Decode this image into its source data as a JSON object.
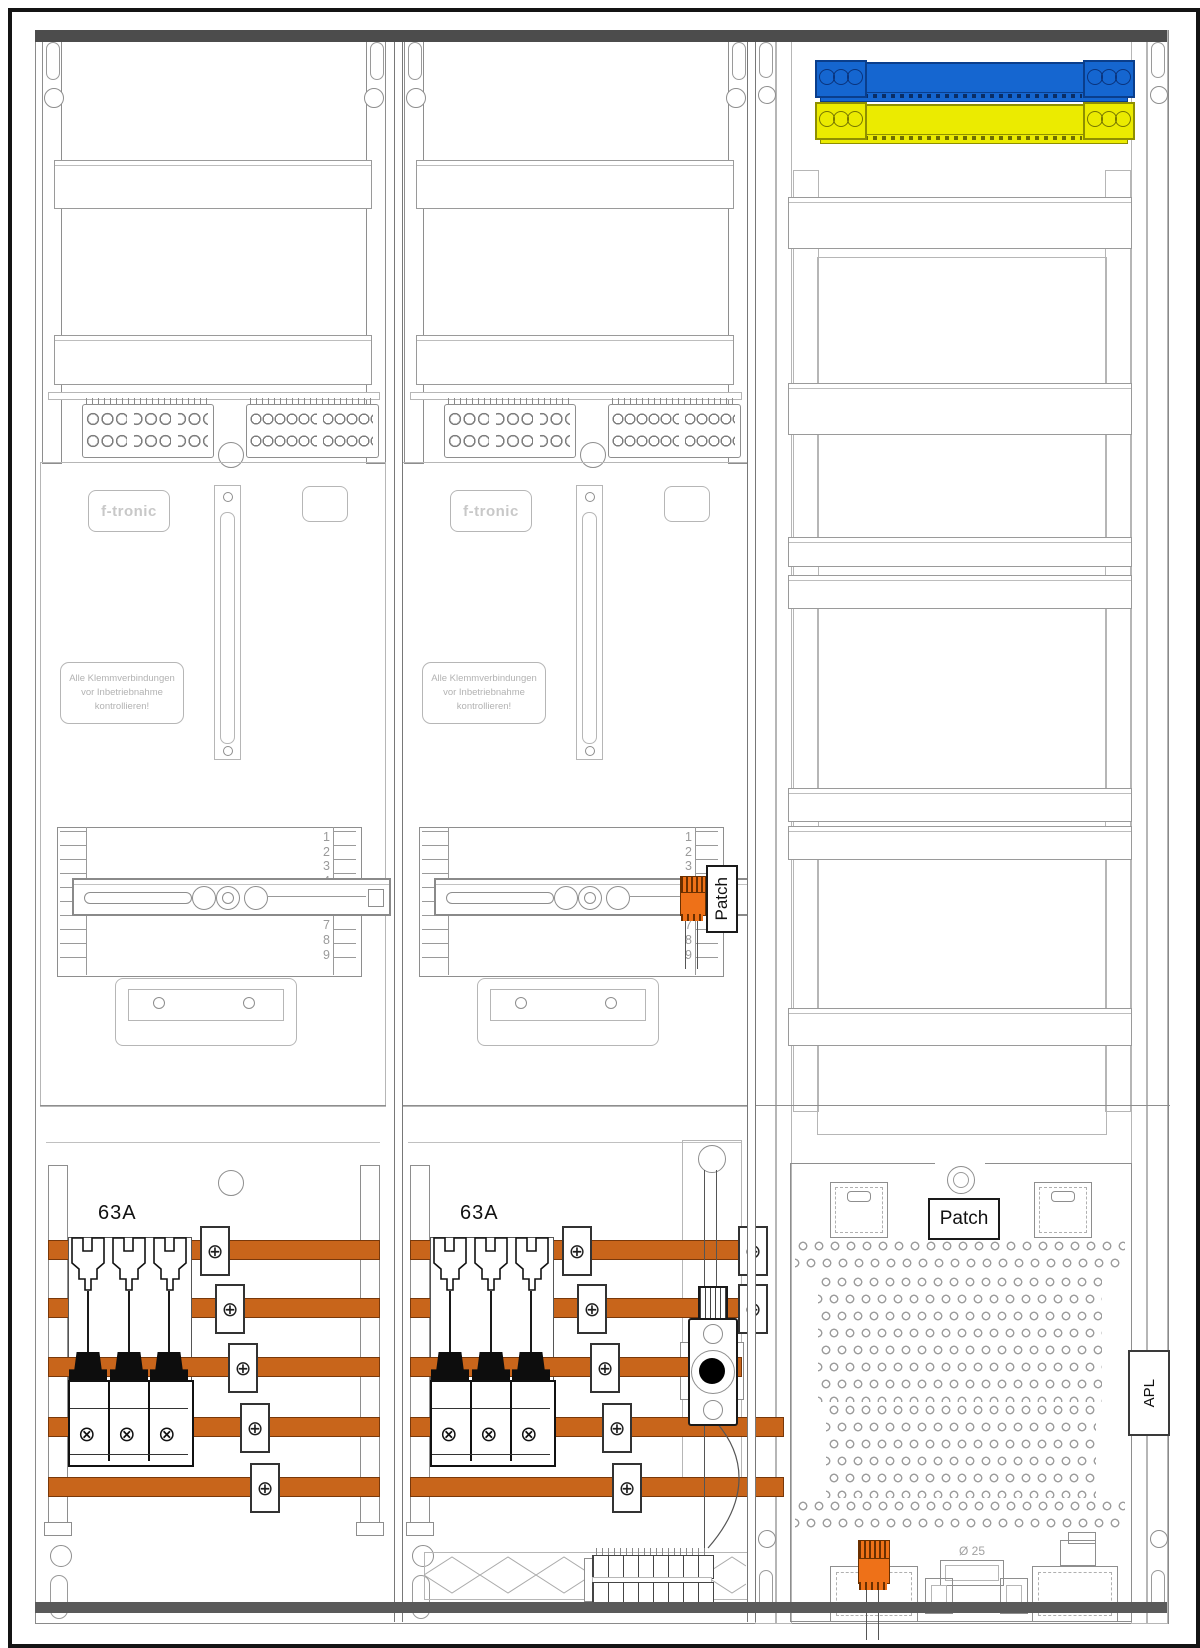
{
  "cabinet": {
    "meter_field_1": {
      "brand": "f-tronic",
      "warning": "Alle Klemmverbindungen\nvor Inbetriebnahme\nkontrollieren!",
      "breaker_rating": "63A",
      "scale_numbers": [
        "1",
        "2",
        "3",
        "4",
        "5",
        "6",
        "7",
        "8",
        "9"
      ]
    },
    "meter_field_2": {
      "brand": "f-tronic",
      "warning": "Alle Klemmverbindungen\nvor Inbetriebnahme\nkontrollieren!",
      "breaker_rating": "63A",
      "scale_numbers": [
        "1",
        "2",
        "3",
        "4",
        "5",
        "6",
        "7",
        "8",
        "9"
      ],
      "patch_label": "Patch"
    },
    "connection_field": {
      "patch_label": "Patch",
      "apl_label": "APL",
      "knockout_label": "Ø 25"
    },
    "colors": {
      "busbar_orange": "#c8651b",
      "connector_orange": "#ee7118",
      "terminal_blue": "#1566d0",
      "terminal_yellow": "#ebeb00"
    }
  },
  "icons": {
    "phillips_screw": "⊕",
    "cross_screw": "⊗"
  }
}
